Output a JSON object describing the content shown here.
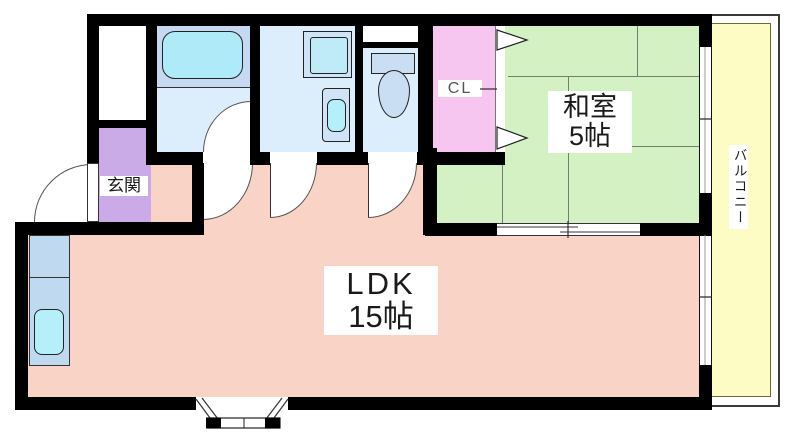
{
  "floor_plan": {
    "rooms": {
      "ldk": {
        "label": "LDK",
        "size": "15帖"
      },
      "washitsu": {
        "label": "和室",
        "size": "5帖"
      },
      "genkan": {
        "label": "玄関"
      },
      "closet": {
        "label": "CL"
      },
      "balcony": {
        "label": "バルコニー"
      }
    },
    "fixtures": [
      "bathtub",
      "washing-machine",
      "washbasin",
      "toilet",
      "kitchen-counter",
      "kitchen-sink"
    ],
    "colors": {
      "ldk": "#f8d3c6",
      "washitsu": "#d3f1c2",
      "genkan": "#cbaae8",
      "closet": "#f7c6f0",
      "balcony": "#fdfcc4",
      "wet_room": "#dcedfc",
      "tub_area": "#c5d9f3",
      "fixture_cyan": "#aeeaf7",
      "wall": "#000000"
    }
  }
}
